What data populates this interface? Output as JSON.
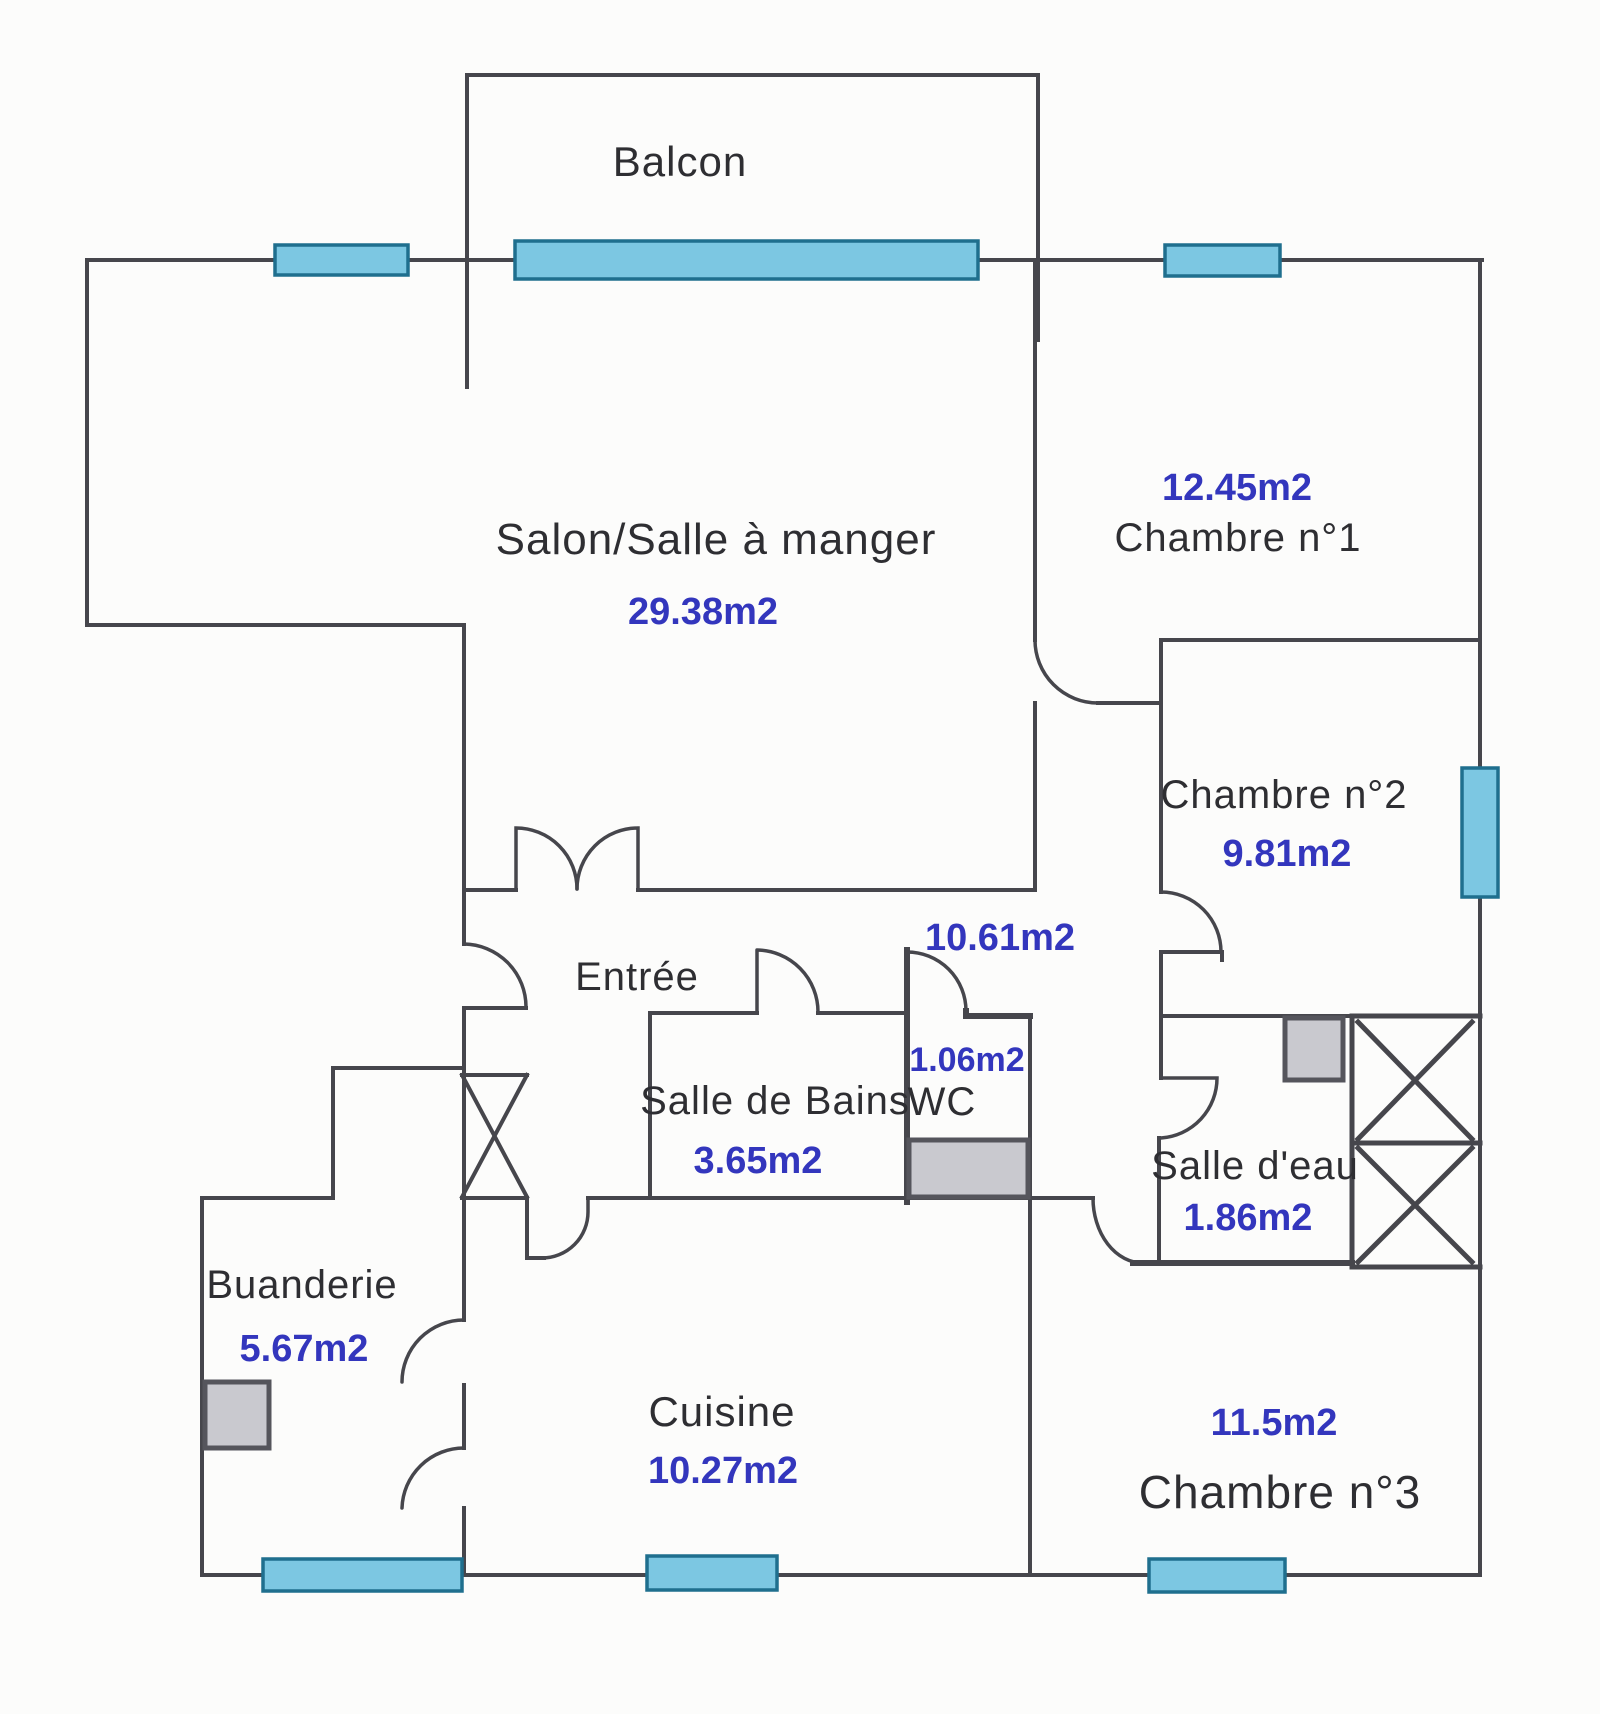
{
  "document": {
    "type": "floor-plan",
    "language": "fr"
  },
  "colors": {
    "bg": "#fcfcfb",
    "wall": "#46464c",
    "window_fill": "#7cc7e2",
    "window_stroke": "#1f6f8e",
    "fixture_fill": "#c9c9cf",
    "fixture_stroke": "#55555c",
    "room_text": "#2e2e32",
    "area_text": "#3336bd"
  },
  "rooms": [
    {
      "id": "balcon",
      "name": "Balcon",
      "area": ""
    },
    {
      "id": "salon",
      "name": "Salon/Salle à manger",
      "area": "29.38m2"
    },
    {
      "id": "chambre1",
      "name": "Chambre n°1",
      "area": "12.45m2"
    },
    {
      "id": "chambre2",
      "name": "Chambre n°2",
      "area": "9.81m2"
    },
    {
      "id": "entree",
      "name": "Entrée",
      "area": "10.61m2"
    },
    {
      "id": "salle_de_bains",
      "name": "Salle de Bains",
      "area": "3.65m2"
    },
    {
      "id": "wc",
      "name": "WC",
      "area": "1.06m2"
    },
    {
      "id": "salle_deau",
      "name": "Salle d'eau",
      "area": "1.86m2"
    },
    {
      "id": "buanderie",
      "name": "Buanderie",
      "area": "5.67m2"
    },
    {
      "id": "cuisine",
      "name": "Cuisine",
      "area": "10.27m2"
    },
    {
      "id": "chambre3",
      "name": "Chambre n°3",
      "area": "11.5m2"
    }
  ]
}
